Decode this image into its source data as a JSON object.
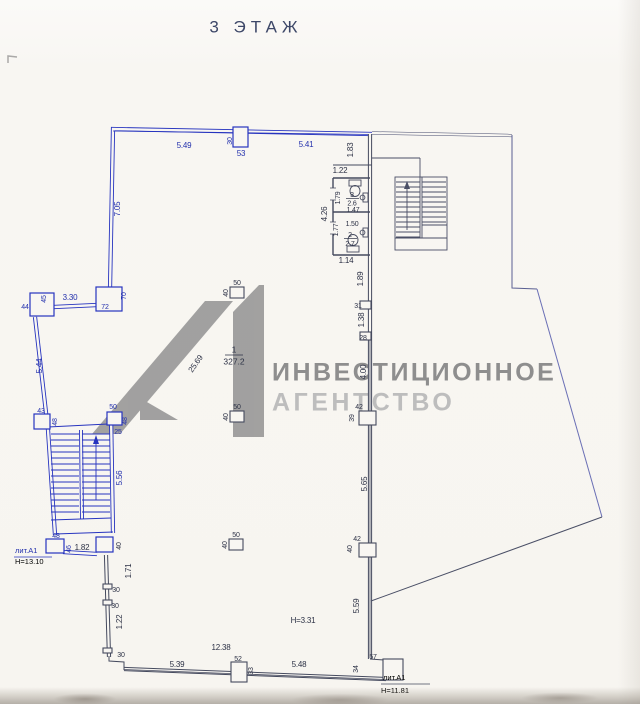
{
  "title": "3 ЭТАЖ",
  "watermark": {
    "logo": "А1",
    "line1": "ИНВЕСТИЦИОННОЕ",
    "line2": "АГЕНТСТВО"
  },
  "rooms": {
    "main": {
      "num": "1",
      "area": "327.2"
    },
    "wc_top": {
      "num": "3",
      "area": "2.6"
    },
    "wc_bottom": {
      "num": "2",
      "area": "2.7"
    }
  },
  "notes": {
    "height_main": "Н=3.31",
    "lit_left": "лит.А1",
    "lit_left_h": "Н=13.10",
    "lit_right": "лит.А1",
    "lit_right_h": "Н=11.81"
  },
  "dims": {
    "top_span_left": "5.49",
    "top_col_w": "30",
    "top_col_d": "53",
    "top_span_right": "5.41",
    "top_v": "1.83",
    "wc_above": "1.22",
    "left_wall": "7.05",
    "colA_w": "72",
    "colA_d": "70",
    "left_span": "3.30",
    "colB_w": "45",
    "colB_d": "44",
    "left_slant": "5.44",
    "colC_w": "43",
    "colC_d": "48",
    "stair_top_w": "50",
    "stair_top_d": "48",
    "stair_top_o": "25",
    "stair_h": "5.56",
    "stair_bot_w": "48",
    "stair_bot_d": "46",
    "vest_w": "1.82",
    "colD_d": "40",
    "lw1": "1.71",
    "lw2": "30",
    "lw3": "30",
    "lw4": "1.22",
    "lw5": "30",
    "bot_total": "12.38",
    "bot_left": "5.39",
    "colE_w": "52",
    "colE_d": "33",
    "bot_right": "5.48",
    "corner_d": "34",
    "corner_w": "57",
    "rw1": "1.89",
    "rw2": "31",
    "rw3": "1.38",
    "rw4": "28",
    "rw5": "4.00",
    "colF_w": "42",
    "colF_d": "39",
    "rw6": "5.65",
    "colG_w": "42",
    "colG_d": "40",
    "rw7": "5.59",
    "wc_h": "4.26",
    "wc3_h": "1.79",
    "wc3_w": "1.47",
    "wc2_w": "1.50",
    "wc2_h": "1.77",
    "wc_below": "1.14",
    "diag": "25.69",
    "picol_w": "50",
    "picol_d": "40"
  },
  "colors": {
    "wall_blue": "#2734bf",
    "line_dark": "#454a5e",
    "dim_text_dark": "#2c3145",
    "dim_text_blue": "#2431ad",
    "watermark_gray": "#8e8e8e",
    "watermark_light": "#bdbdbd",
    "background": "#f8f6f2"
  }
}
